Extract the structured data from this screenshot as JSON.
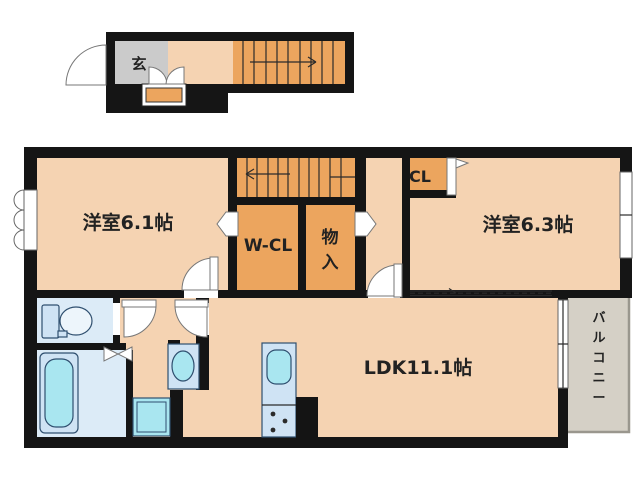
{
  "rooms": {
    "entrance": "玄",
    "bedroom_1": "洋室6.1帖",
    "walk_in_closet": "W-CL",
    "storage": "物入",
    "closet": "CL",
    "bedroom_2": "洋室6.3帖",
    "ldk": "LDK11.1帖",
    "balcony": "バルコニー"
  },
  "colors": {
    "background": "#ffffff",
    "wall": "#151515",
    "room_fill": "#f5d3b2",
    "closet_fill": "#eca55e",
    "entrance_tile": "#cbcbcb",
    "balcony_fill": "#d5d0c6",
    "wet_room_fill": "#dcebf7",
    "fixture_light_blue": "#cfe3f4",
    "fixture_cyan": "#a9e6f0"
  }
}
